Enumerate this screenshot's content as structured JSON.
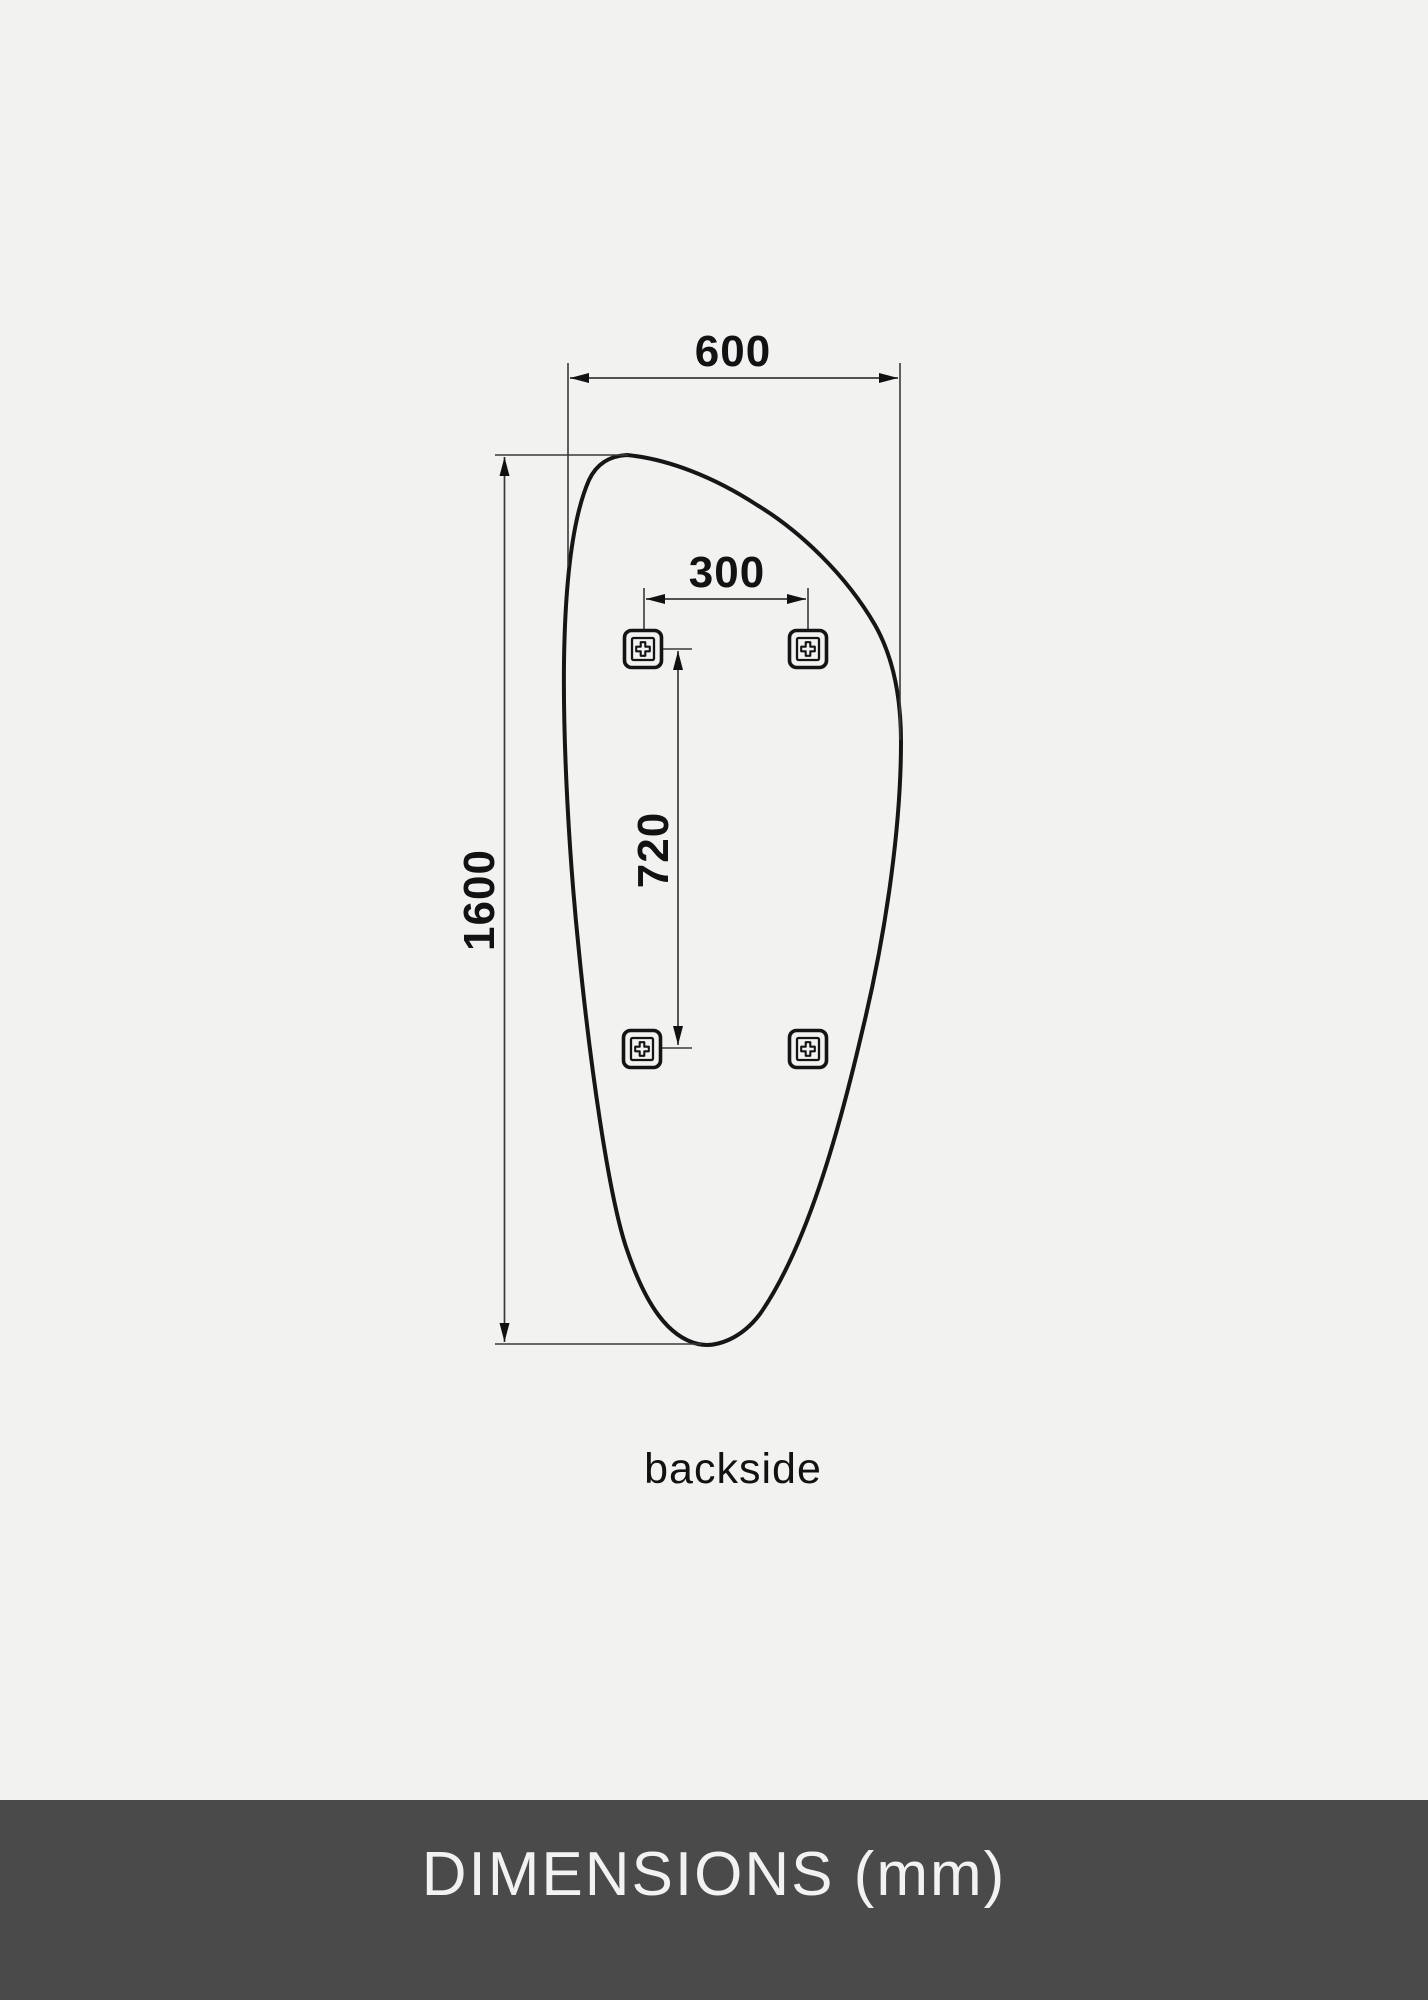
{
  "colors": {
    "background": "#f2f2f1",
    "line": "#161616",
    "footer_background": "#4a4a4a",
    "footer_text": "#f2f2f2"
  },
  "diagram": {
    "width_label": "600",
    "height_label": "1600",
    "holes_width_label": "300",
    "holes_height_label": "720",
    "view_label": "backside"
  },
  "icons": {
    "bracket": "phillips-screw-icon"
  },
  "footer": {
    "title": "DIMENSIONS (mm)"
  }
}
